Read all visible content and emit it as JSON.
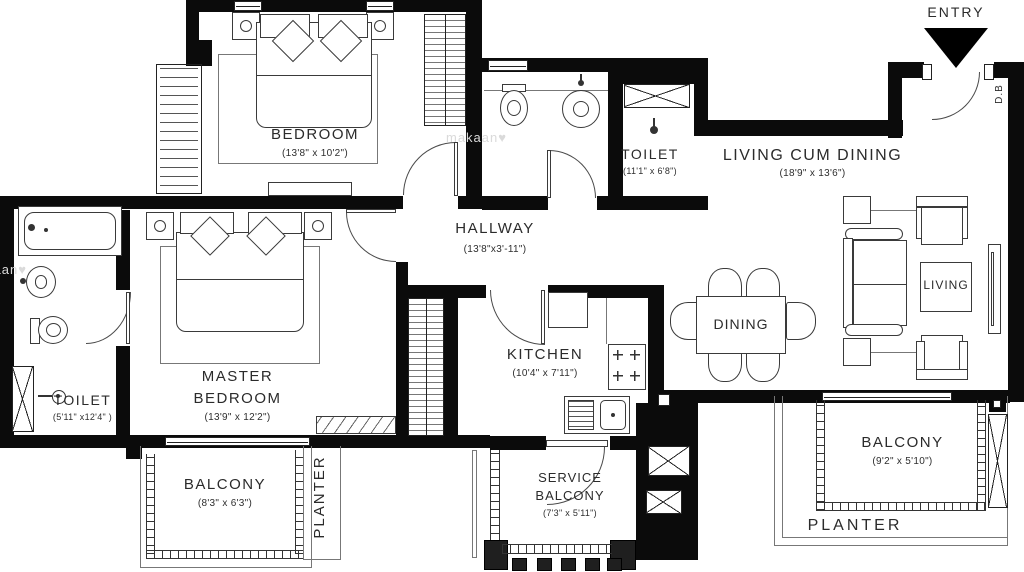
{
  "plan": {
    "entry": {
      "label": "ENTRY",
      "db": "D.B"
    },
    "watermark": "makaan♥",
    "rooms": {
      "bedroom": {
        "name": "BEDROOM",
        "dims": "(13'8\" x 10'2\")"
      },
      "toilet_common": {
        "name": "TOILET",
        "dims": "(11'1\" x 6'8\")"
      },
      "living_dining": {
        "name": "LIVING CUM DINING",
        "dims": "(18'9\" x 13'6\")"
      },
      "hallway": {
        "name": "HALLWAY",
        "dims": "(13'8\"x3'-11\")"
      },
      "master_bedroom": {
        "name_line1": "MASTER",
        "name_line2": "BEDROOM",
        "dims": "(13'9\" x 12'2\")"
      },
      "toilet_master": {
        "name": "TOILET",
        "dims": "(5'11\" x12'4\" )"
      },
      "kitchen": {
        "name": "KITCHEN",
        "dims": "(10'4\" x 7'11\")"
      },
      "balcony_master": {
        "name": "BALCONY",
        "dims": "(8'3\" x 6'3\")"
      },
      "service_balcony": {
        "name_line1": "SERVICE",
        "name_line2": "BALCONY",
        "dims": "(7'3\" x 5'11\")"
      },
      "balcony_living": {
        "name": "BALCONY",
        "dims": "(9'2\" x 5'10\")"
      },
      "planter_master": {
        "name": "PLANTER"
      },
      "planter_living": {
        "name": "PLANTER"
      },
      "dining_area": {
        "name": "DINING"
      },
      "living_area": {
        "name": "LIVING"
      }
    },
    "colors": {
      "wall": "#0b0b0b",
      "line": "#3a3a3a",
      "text": "#2b2b2b",
      "watermark": "#dadada"
    }
  }
}
